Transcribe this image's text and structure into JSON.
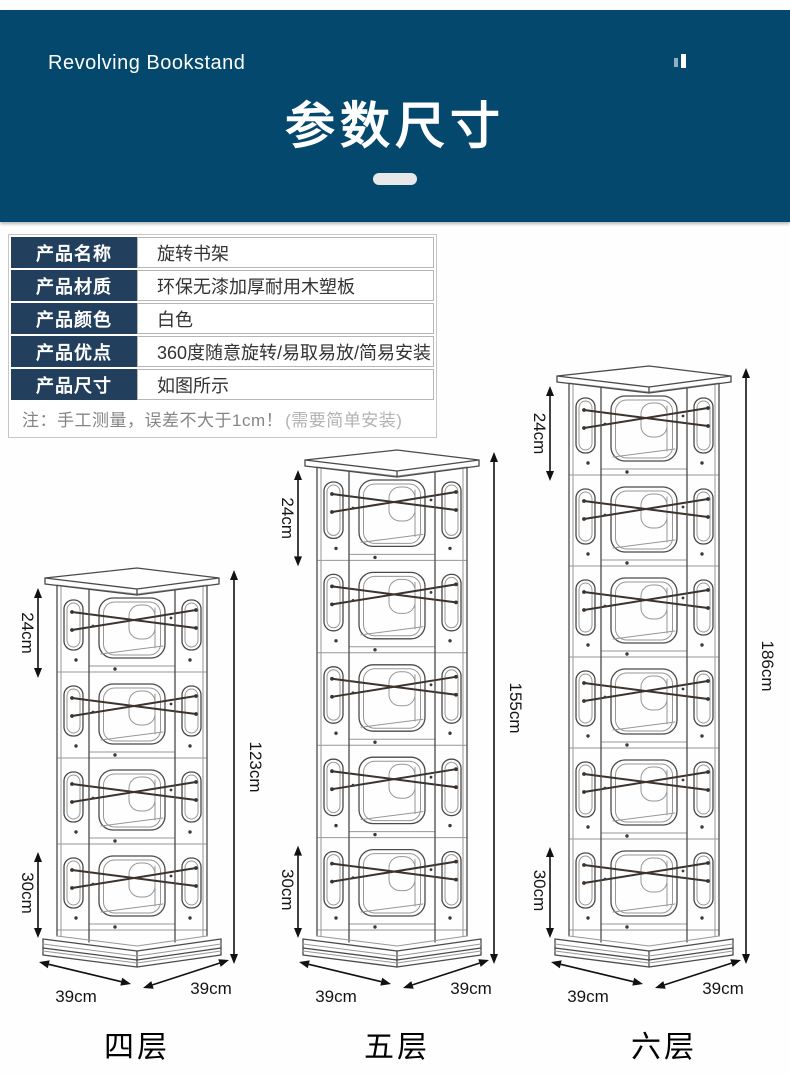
{
  "colors": {
    "banner_bg": "#05486D",
    "table_label_bg": "#223F5E",
    "line_art": "#4a4a4a",
    "dimension_text": "#151515"
  },
  "header": {
    "brand": "Revolving Bookstand",
    "title": "参数尺寸"
  },
  "spec_table": {
    "rows": [
      {
        "label": "产品名称",
        "value": "旋转书架"
      },
      {
        "label": "产品材质",
        "value": "环保无漆加厚耐用木塑板"
      },
      {
        "label": "产品颜色",
        "value": "白色"
      },
      {
        "label": "产品优点",
        "value": "360度随意旋转/易取易放/简易安装"
      },
      {
        "label": "产品尺寸",
        "value": "如图所示"
      }
    ],
    "note_main": "注：手工测量，误差不大于1cm！",
    "note_sub": "(需要简单安装)"
  },
  "diagrams": {
    "shelves": [
      {
        "id": "four-tier",
        "name": "四层",
        "tiers": 4,
        "height_label": "123cm",
        "top_label": "24cm",
        "bottom_label": "30cm",
        "front_label": "39cm",
        "side_label": "39cm"
      },
      {
        "id": "five-tier",
        "name": "五层",
        "tiers": 5,
        "height_label": "155cm",
        "top_label": "24cm",
        "bottom_label": "30cm",
        "front_label": "39cm",
        "side_label": "39cm"
      },
      {
        "id": "six-tier",
        "name": "六层",
        "tiers": 6,
        "height_label": "186cm",
        "top_label": "24cm",
        "bottom_label": "30cm",
        "front_label": "39cm",
        "side_label": "39cm"
      }
    ]
  }
}
